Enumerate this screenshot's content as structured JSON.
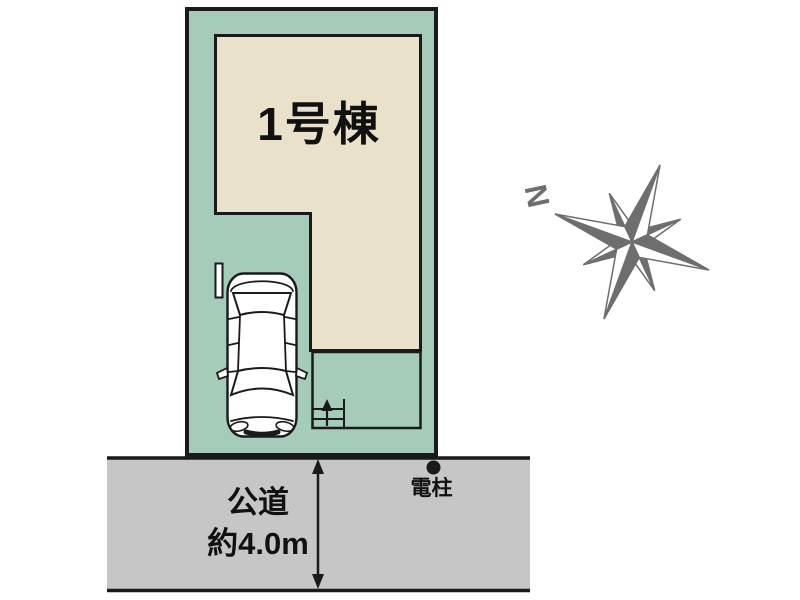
{
  "site_plan": {
    "building": {
      "label": "1号棟"
    },
    "road": {
      "label_line1": "公道",
      "label_line2": "約4.0m"
    },
    "utility_pole": {
      "label": "電柱"
    },
    "compass": {
      "north_label": "N"
    }
  },
  "colors": {
    "plot_fill": "#a5ccb9",
    "building_fill": "#e9e1c9",
    "road_fill": "#c6c6c6",
    "line": "#1a1a1a",
    "compass": "#6e6e6e",
    "car_fill": "#ffffff"
  }
}
